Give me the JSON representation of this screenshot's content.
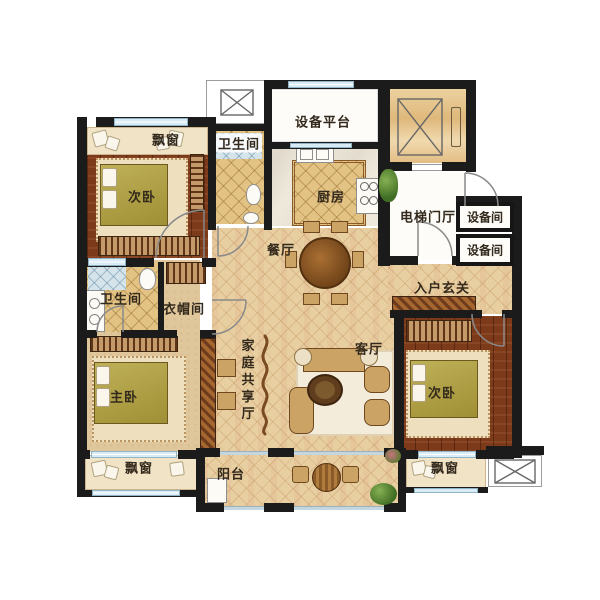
{
  "plan": {
    "type": "apartment-floor-plan",
    "palette": {
      "wall": "#1b1b1b",
      "hall_floor": "#e8cfa1",
      "wood_floor": "#7c3a1b",
      "tile_floor": "#e3c384",
      "bay_window": "#f0e3c6",
      "window_glass": "#d9ecf5",
      "bed": "#a89a3e",
      "white_room": "#fdfcf8"
    },
    "rooms": {
      "bay_top_left": {
        "label": "飘窗"
      },
      "bedroom_top_left": {
        "label": "次卧"
      },
      "bath_top": {
        "label": "卫生间"
      },
      "equipment_platform": {
        "label": "设备平台"
      },
      "kitchen": {
        "label": "厨房"
      },
      "elevator_lobby": {
        "label": "电梯门厅"
      },
      "equipment_room_1": {
        "label": "设备间"
      },
      "equipment_room_2": {
        "label": "设备间"
      },
      "dining": {
        "label": "餐厅"
      },
      "entry_foyer": {
        "label": "入户玄关"
      },
      "bath_left": {
        "label": "卫生间"
      },
      "cloakroom": {
        "label": "衣帽间"
      },
      "master_bedroom": {
        "label": "主卧"
      },
      "family_hall": {
        "label": "家庭共享厅"
      },
      "living_room": {
        "label": "客厅"
      },
      "bedroom_right": {
        "label": "次卧"
      },
      "bay_bottom_left": {
        "label": "飘窗"
      },
      "balcony": {
        "label": "阳台"
      },
      "bay_bottom_right": {
        "label": "飘窗"
      }
    }
  }
}
